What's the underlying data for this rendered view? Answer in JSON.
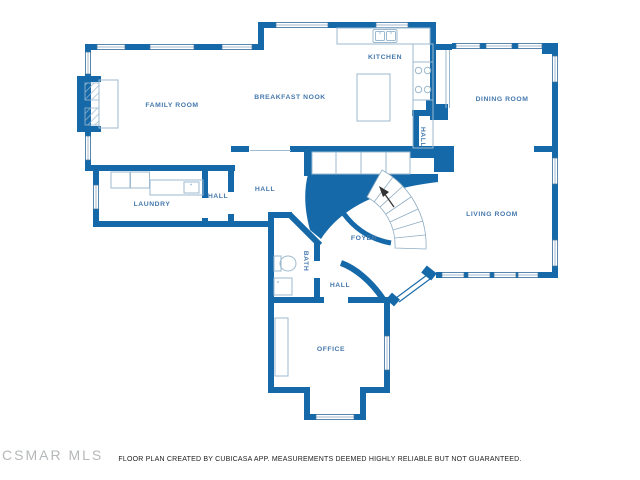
{
  "watermark": {
    "text": "CSMAR MLS"
  },
  "footer": {
    "disclaimer": "FLOOR PLAN CREATED BY CUBICASA APP. MEASUREMENTS DEEMED HIGHLY RELIABLE BUT NOT GUARANTEED."
  },
  "floor_plan": {
    "rooms": [
      {
        "id": "family-room",
        "label": "FAMILY ROOM"
      },
      {
        "id": "breakfast-nook",
        "label": "BREAKFAST NOOK"
      },
      {
        "id": "kitchen",
        "label": "KITCHEN"
      },
      {
        "id": "dining-room",
        "label": "DINING ROOM"
      },
      {
        "id": "hall-upper",
        "label": "HALL"
      },
      {
        "id": "laundry",
        "label": "LAUNDRY"
      },
      {
        "id": "hall-laundry",
        "label": "HALL"
      },
      {
        "id": "hall-center",
        "label": "HALL"
      },
      {
        "id": "living-room",
        "label": "LIVING ROOM"
      },
      {
        "id": "foyer",
        "label": "FOYER"
      },
      {
        "id": "bath",
        "label": "BATH"
      },
      {
        "id": "hall-lower",
        "label": "HALL"
      },
      {
        "id": "office",
        "label": "OFFICE"
      }
    ],
    "fixtures": [
      "fireplace",
      "kitchen-island",
      "kitchen-sink",
      "stove",
      "washer-dryer",
      "laundry-sink",
      "toilet",
      "bath-sink",
      "curved-staircase",
      "closet-row",
      "front-double-door",
      "bay-window",
      "desk"
    ],
    "colors": {
      "wall": "#1569a8",
      "room_label": "#4578ad",
      "furniture_outline": "#9cb9cf",
      "watermark": "#b5b8ba",
      "footer_text": "#222222",
      "background": "#ffffff"
    }
  }
}
